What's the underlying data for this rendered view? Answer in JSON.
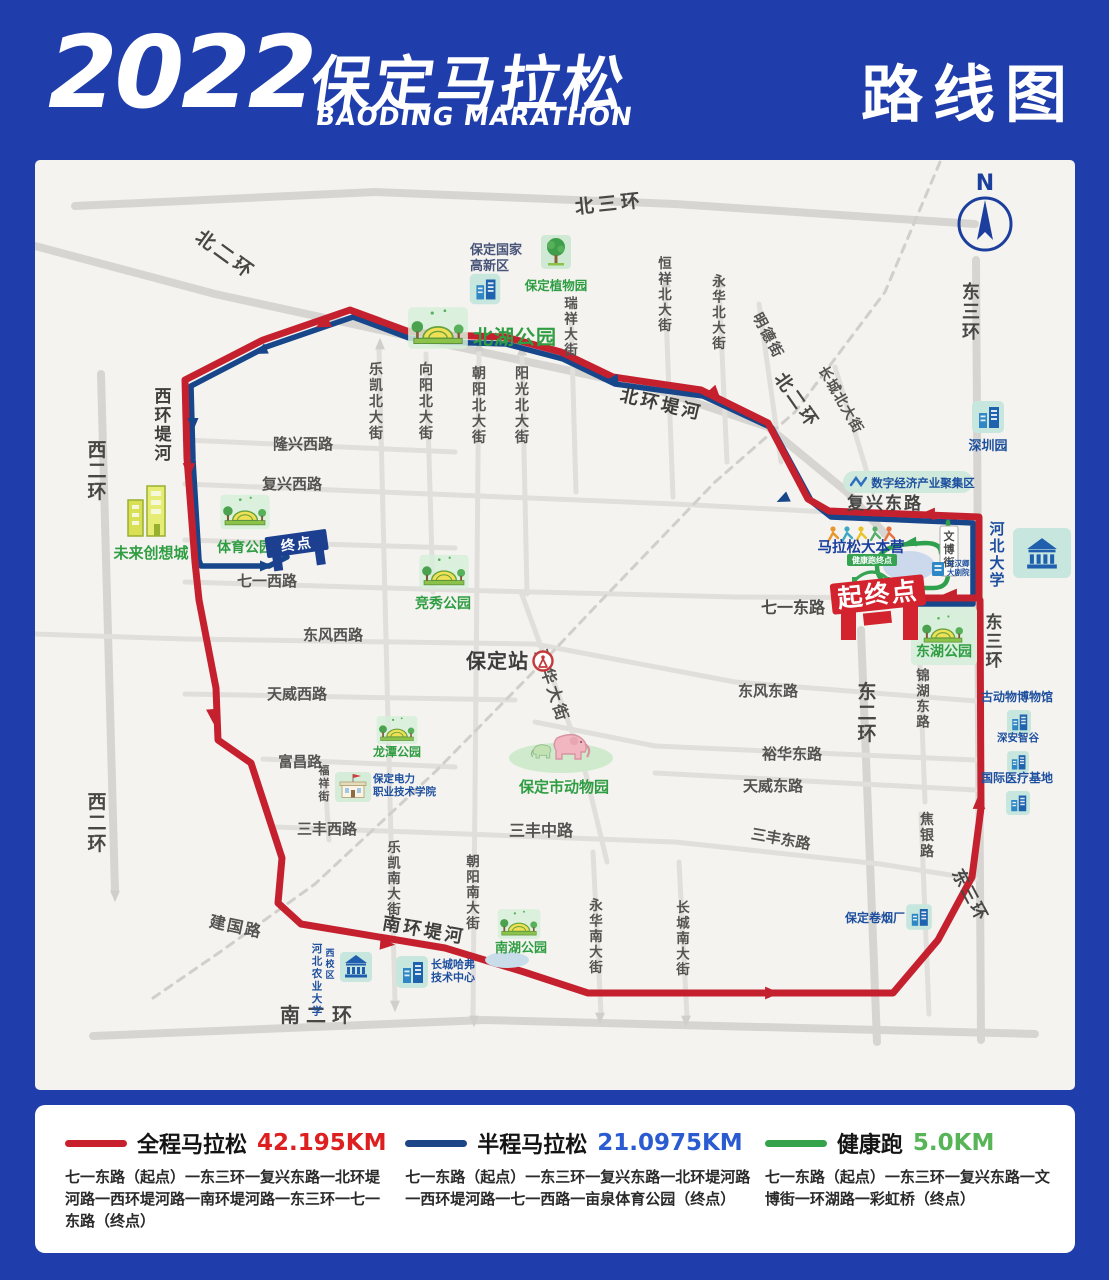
{
  "header": {
    "year": "2022",
    "title_cn": "保定马拉松",
    "title_en": "BAODING MARATHON",
    "page_title": "路线图"
  },
  "map": {
    "compass_label": "N",
    "route_colors": {
      "full": "#c5202e",
      "half": "#17468a",
      "health": "#2fa04e"
    },
    "road_labels": [
      {
        "id": "n3h",
        "text": "北三环"
      },
      {
        "id": "n2h_w",
        "text": "北二环"
      },
      {
        "id": "n2h_e",
        "text": "北二环"
      },
      {
        "id": "w2h_n",
        "text": "西二环"
      },
      {
        "id": "w2h_s",
        "text": "西二环"
      },
      {
        "id": "s2h",
        "text": "南二环"
      },
      {
        "id": "e2h",
        "text": "东二环"
      },
      {
        "id": "e3h_n",
        "text": "东三环"
      },
      {
        "id": "e3h_m",
        "text": "东三环"
      },
      {
        "id": "e3h_s",
        "text": "东三环"
      },
      {
        "id": "xihuandihe",
        "text": "西环堤河"
      },
      {
        "id": "beihuandihe",
        "text": "北环堤河"
      },
      {
        "id": "nanhuandihe",
        "text": "南环堤河"
      },
      {
        "id": "jianguolu",
        "text": "建国路"
      },
      {
        "id": "lekai_n",
        "text": "乐凯北大街"
      },
      {
        "id": "xiangyang_n",
        "text": "向阳北大街"
      },
      {
        "id": "chaoyang_n",
        "text": "朝阳北大街"
      },
      {
        "id": "yangguang_n",
        "text": "阳光北大街"
      },
      {
        "id": "ruixiang",
        "text": "瑞祥大街"
      },
      {
        "id": "hengxiang_n",
        "text": "恒祥北大街"
      },
      {
        "id": "yonghua_n",
        "text": "永华北大街"
      },
      {
        "id": "mingde",
        "text": "明德街"
      },
      {
        "id": "changcheng_n",
        "text": "长城北大街"
      },
      {
        "id": "longxing_w",
        "text": "隆兴西路"
      },
      {
        "id": "fuxing_w",
        "text": "复兴西路"
      },
      {
        "id": "fuxing_e",
        "text": "复兴东路"
      },
      {
        "id": "qiyi_w",
        "text": "七一西路"
      },
      {
        "id": "qiyi_e",
        "text": "七一东路"
      },
      {
        "id": "dongfeng_w",
        "text": "东风西路"
      },
      {
        "id": "dongfeng_e",
        "text": "东风东路"
      },
      {
        "id": "tianwei_w",
        "text": "天威西路"
      },
      {
        "id": "tianwei_e",
        "text": "天威东路"
      },
      {
        "id": "yuhua_e",
        "text": "裕华东路"
      },
      {
        "id": "sanfeng_w",
        "text": "三丰西路"
      },
      {
        "id": "sanfeng_m",
        "text": "三丰中路"
      },
      {
        "id": "sanfeng_e",
        "text": "三丰东路"
      },
      {
        "id": "fuchang",
        "text": "富昌路"
      },
      {
        "id": "fuxiang",
        "text": "福祥街"
      },
      {
        "id": "jianhua",
        "text": "建华大街"
      },
      {
        "id": "lekai_s",
        "text": "乐凯南大街"
      },
      {
        "id": "chaoyang_s",
        "text": "朝阳南大街"
      },
      {
        "id": "yonghua_s",
        "text": "永华南大街"
      },
      {
        "id": "changcheng_s",
        "text": "长城南大街"
      },
      {
        "id": "jinhu_e",
        "text": "锦湖东路"
      },
      {
        "id": "jiaoyin",
        "text": "焦银路"
      }
    ],
    "landmarks": [
      {
        "id": "gaoxinqu",
        "lines": [
          "保定国家",
          "高新区"
        ],
        "icon": "building"
      },
      {
        "id": "zhiwuyuan",
        "text": "保定植物园",
        "icon": "tree"
      },
      {
        "id": "beihu",
        "text": "北湖公园",
        "icon": "park"
      },
      {
        "id": "shenzhenyuan",
        "text": "深圳园",
        "icon": "building"
      },
      {
        "id": "shuzijingji",
        "text": "数字经济产业聚集区",
        "icon": "wave"
      },
      {
        "id": "weilai",
        "text": "未来创想城",
        "icon": "city"
      },
      {
        "id": "tiyu",
        "text": "体育公园",
        "icon": "park"
      },
      {
        "id": "jingxiu",
        "text": "竞秀公园",
        "icon": "park"
      },
      {
        "id": "longtan",
        "text": "龙潭公园",
        "icon": "park"
      },
      {
        "id": "dianli",
        "lines": [
          "保定电力",
          "职业技术学院"
        ],
        "icon": "school"
      },
      {
        "id": "bdstation",
        "text": "保定站",
        "icon": "rail"
      },
      {
        "id": "zoo",
        "text": "保定市动物园",
        "icon": "elephants"
      },
      {
        "id": "nanhu",
        "text": "南湖公园",
        "icon": "park"
      },
      {
        "id": "haval",
        "lines": [
          "长城哈弗",
          "技术中心"
        ],
        "icon": "building"
      },
      {
        "id": "nongda",
        "lines": [
          "河北农业大学",
          "西校区"
        ],
        "icon": "temple"
      },
      {
        "id": "juanyan",
        "text": "保定卷烟厂",
        "icon": "building"
      },
      {
        "id": "gudongwu",
        "text": "古动物博物馆",
        "icon": "building"
      },
      {
        "id": "shenan",
        "text": "深安智谷",
        "icon": "building"
      },
      {
        "id": "yiliao",
        "text": "国际医疗基地",
        "icon": "building"
      },
      {
        "id": "hebeidaxue",
        "text": "河北大学",
        "icon": "temple"
      },
      {
        "id": "wenbojie",
        "text": "文博街",
        "icon": "boxed"
      },
      {
        "id": "guanhanqing",
        "lines": [
          "关汉卿",
          "大剧院"
        ],
        "icon": "minib"
      },
      {
        "id": "dabenying",
        "text": "马拉松大本营",
        "icon": "runners"
      },
      {
        "id": "donghu",
        "text": "东湖公园",
        "icon": "park"
      }
    ],
    "markers": [
      {
        "id": "start_finish",
        "text": "起终点"
      },
      {
        "id": "half_finish",
        "text": "终点"
      },
      {
        "id": "health_finish",
        "text": "健康跑终点"
      }
    ]
  },
  "legend": {
    "items": [
      {
        "id": "full",
        "label": "全程马拉松",
        "distance": "42.195KM",
        "color": "#c8202d",
        "value_color": "#de1f1f",
        "route": "七一东路（起点）一东三环一复兴东路一北环堤河路一西环堤河路一南环堤河路一东三环一七一东路（终点）"
      },
      {
        "id": "half",
        "label": "半程马拉松",
        "distance": "21.0975KM",
        "color": "#1c4587",
        "value_color": "#2a5bd0",
        "route": "七一东路（起点）一东三环一复兴东路一北环堤河路一西环堤河路一七一西路一亩泉体育公园（终点）"
      },
      {
        "id": "health",
        "label": "健康跑",
        "distance": "5.0KM",
        "color": "#35a24c",
        "value_color": "#57b457",
        "route": "七一东路（起点）一东三环一复兴东路一文博街一环湖路一彩虹桥（终点）"
      }
    ]
  }
}
